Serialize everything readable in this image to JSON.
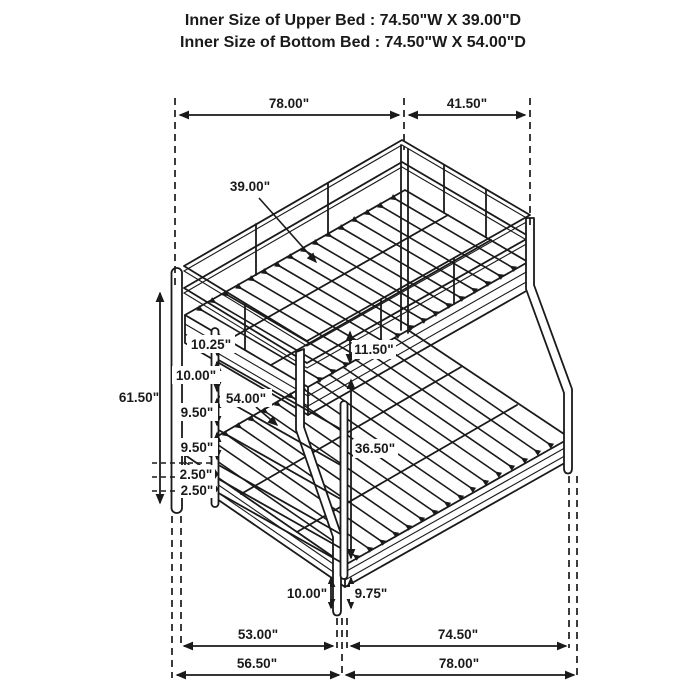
{
  "title": {
    "line1": "Inner Size of Upper Bed : 74.50\"W X 39.00\"D",
    "line2": "Inner Size of Bottom Bed : 74.50\"W X 54.00\"D"
  },
  "dims": {
    "top_width": "78.00\"",
    "top_side": "41.50\"",
    "upper_bed_depth": "39.00\"",
    "overall_height": "61.50\"",
    "ladder_gap_1": "10.25\"",
    "ladder_gap_2": "10.00\"",
    "ladder_gap_3": "9.50\"",
    "ladder_gap_4": "9.50\"",
    "ladder_gap_5": "2.50\"",
    "ladder_gap_6": "2.50\"",
    "lower_bed_depth": "54.00\"",
    "guard_rail_height": "11.50\"",
    "under_clearance": "36.50\"",
    "front_leg_height": "10.00\"",
    "lower_frame_height": "9.75\"",
    "bottom_left_inner": "53.00\"",
    "bottom_right_inner": "74.50\"",
    "bottom_left_outer": "56.50\"",
    "bottom_right_outer": "78.00\""
  },
  "colors": {
    "line": "#1a1a1a",
    "background": "#ffffff"
  }
}
